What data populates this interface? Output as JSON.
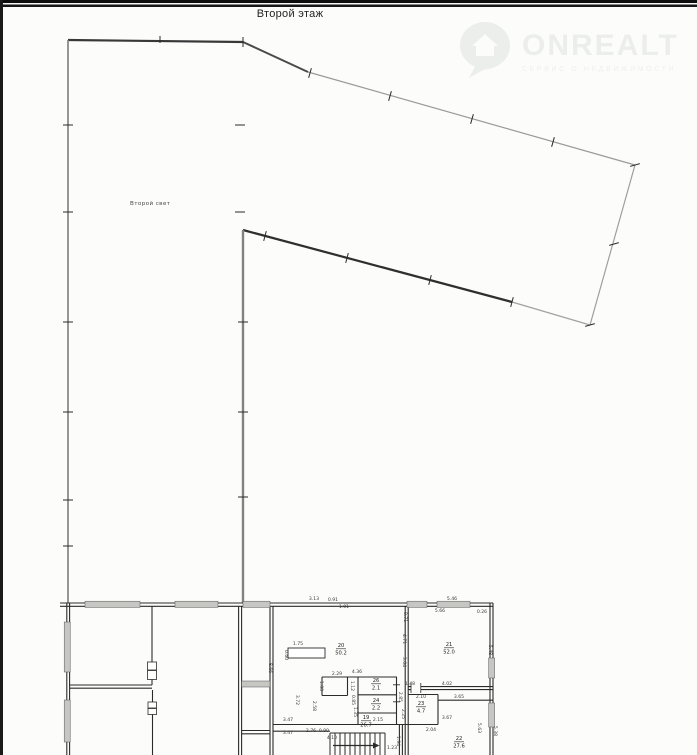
{
  "page": {
    "title": "Второй этаж"
  },
  "watermark": {
    "brand": "ONREALT",
    "tagline": "СЕРВИС О НЕДВИЖИМОСТИ",
    "icon": "location-pin-house-icon"
  },
  "plan": {
    "area_label": "Второй свет",
    "rooms": [
      {
        "number": "20",
        "area": "50.2",
        "x": 341,
        "y": 647
      },
      {
        "number": "21",
        "area": "52.0",
        "x": 449,
        "y": 646
      },
      {
        "number": "22",
        "area": "27.6",
        "x": 459,
        "y": 740
      },
      {
        "number": "23",
        "area": "4.7",
        "x": 421,
        "y": 705
      },
      {
        "number": "26",
        "area": "2.1",
        "x": 376,
        "y": 682
      },
      {
        "number": "24",
        "area": "2.2",
        "x": 376,
        "y": 702
      },
      {
        "number": "19",
        "area": "26.7",
        "x": 366,
        "y": 719
      }
    ],
    "dimensions": [
      {
        "text": "3.13",
        "x": 314,
        "y": 600,
        "rot": 0
      },
      {
        "text": "0.91",
        "x": 333,
        "y": 601,
        "rot": 0
      },
      {
        "text": "1.01",
        "x": 344,
        "y": 608,
        "rot": 0
      },
      {
        "text": "5.46",
        "x": 452,
        "y": 600,
        "rot": 0
      },
      {
        "text": "5.66",
        "x": 440,
        "y": 612,
        "rot": 0
      },
      {
        "text": "0.26",
        "x": 482,
        "y": 613,
        "rot": 0
      },
      {
        "text": "0.71",
        "x": 404,
        "y": 617,
        "rot": 90
      },
      {
        "text": "4.71",
        "x": 403,
        "y": 639,
        "rot": 90
      },
      {
        "text": "3.04",
        "x": 403,
        "y": 662,
        "rot": 90
      },
      {
        "text": "5.48",
        "x": 489,
        "y": 650,
        "rot": 90
      },
      {
        "text": "4.02",
        "x": 447,
        "y": 685,
        "rot": 0
      },
      {
        "text": "1.75",
        "x": 298,
        "y": 645,
        "rot": 0
      },
      {
        "text": "0.60",
        "x": 285,
        "y": 655,
        "rot": 90
      },
      {
        "text": "8.66",
        "x": 269,
        "y": 668,
        "rot": 90
      },
      {
        "text": "4.36",
        "x": 357,
        "y": 673,
        "rot": 0
      },
      {
        "text": "2.29",
        "x": 337,
        "y": 675,
        "rot": 0
      },
      {
        "text": "1.00",
        "x": 320,
        "y": 686,
        "rot": 90
      },
      {
        "text": "1.12",
        "x": 351,
        "y": 686,
        "rot": 90
      },
      {
        "text": "0.85",
        "x": 352,
        "y": 700,
        "rot": 90
      },
      {
        "text": "1.35",
        "x": 354,
        "y": 712,
        "rot": 90
      },
      {
        "text": "2.85",
        "x": 399,
        "y": 697,
        "rot": 90
      },
      {
        "text": "2.25",
        "x": 402,
        "y": 714,
        "rot": 90
      },
      {
        "text": "3.72",
        "x": 296,
        "y": 700,
        "rot": 90
      },
      {
        "text": "2.58",
        "x": 313,
        "y": 706,
        "rot": 90
      },
      {
        "text": "1.48",
        "x": 410,
        "y": 685,
        "rot": 0
      },
      {
        "text": "2.10",
        "x": 421,
        "y": 698,
        "rot": 0
      },
      {
        "text": "3.65",
        "x": 459,
        "y": 698,
        "rot": 0
      },
      {
        "text": "3.67",
        "x": 447,
        "y": 719,
        "rot": 0
      },
      {
        "text": "2.04",
        "x": 431,
        "y": 731,
        "rot": 0
      },
      {
        "text": "5.63",
        "x": 478,
        "y": 728,
        "rot": 90
      },
      {
        "text": "5.38",
        "x": 494,
        "y": 731,
        "rot": 90
      },
      {
        "text": "3.47",
        "x": 288,
        "y": 721,
        "rot": 0
      },
      {
        "text": "3.47",
        "x": 288,
        "y": 734,
        "rot": 0
      },
      {
        "text": "2.76",
        "x": 311,
        "y": 732,
        "rot": 0
      },
      {
        "text": "0.90",
        "x": 324,
        "y": 732,
        "rot": 0
      },
      {
        "text": "2.15",
        "x": 378,
        "y": 721,
        "rot": 0
      },
      {
        "text": "4.10",
        "x": 332,
        "y": 739,
        "rot": 0
      },
      {
        "text": "1.23",
        "x": 392,
        "y": 749,
        "rot": 0
      },
      {
        "text": "1.94",
        "x": 397,
        "y": 741,
        "rot": 90
      }
    ]
  }
}
